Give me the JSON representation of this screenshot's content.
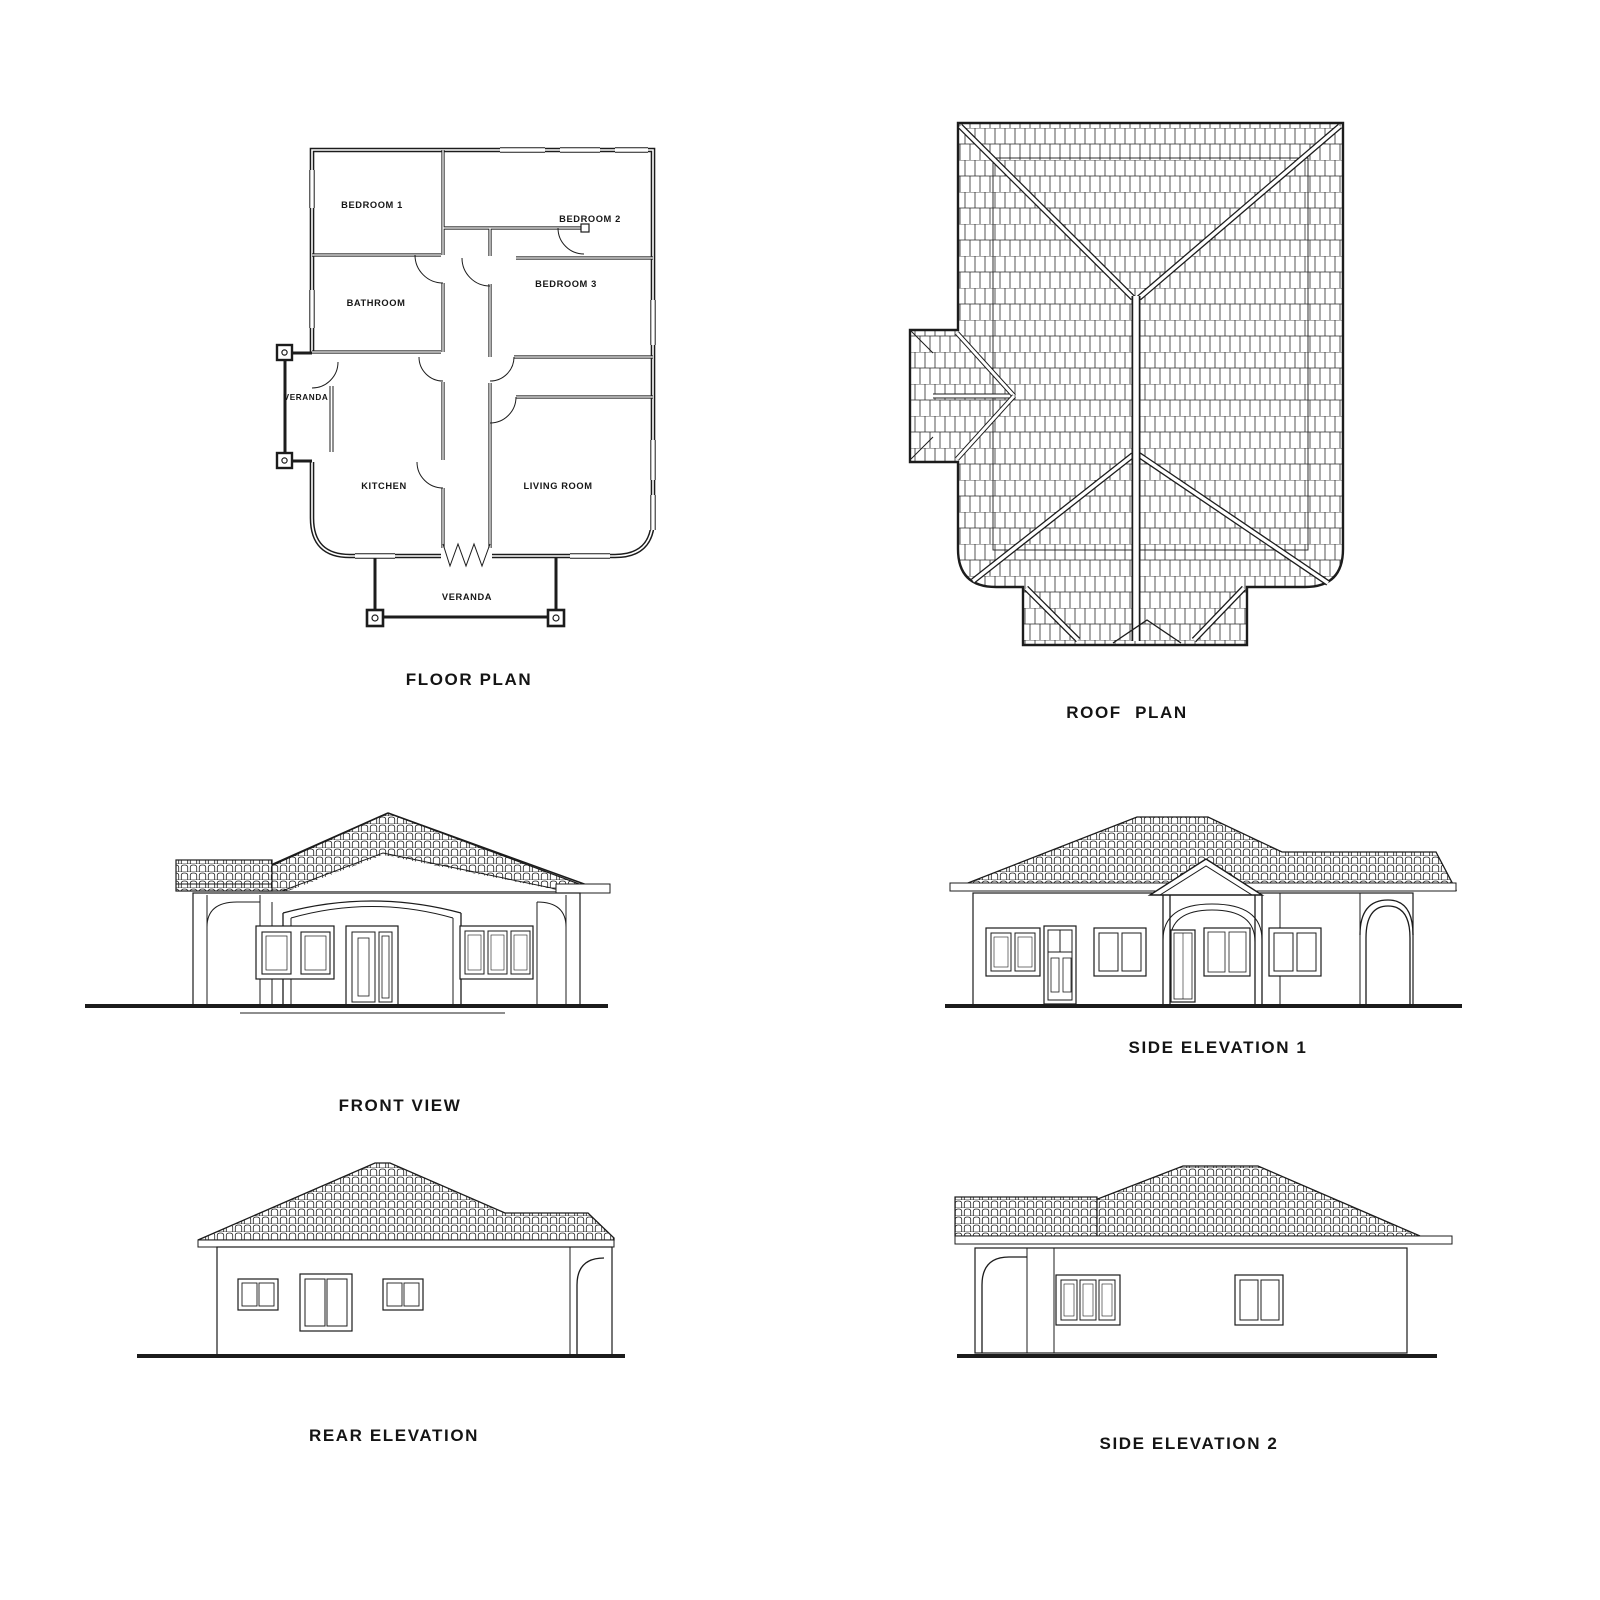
{
  "sheet": {
    "background": "#ffffff",
    "ink": "#1c1c1c"
  },
  "panels": {
    "floor_plan": {
      "label": "FLOOR PLAN",
      "rooms": {
        "bedroom1": "BEDROOM 1",
        "bedroom2": "BEDROOM 2",
        "bathroom": "BATHROOM",
        "bedroom3": "BEDROOM 3",
        "veranda_side": "VERANDA",
        "kitchen": "KITCHEN",
        "living_room": "LIVING ROOM",
        "veranda_front": "VERANDA"
      }
    },
    "roof_plan": {
      "label": "ROOF PLAN"
    },
    "front_view": {
      "label": "FRONT VIEW"
    },
    "side_elevation_1": {
      "label": "SIDE ELEVATION 1"
    },
    "rear_elevation": {
      "label": "REAR ELEVATION"
    },
    "side_elevation_2": {
      "label": "SIDE ELEVATION 2"
    }
  }
}
